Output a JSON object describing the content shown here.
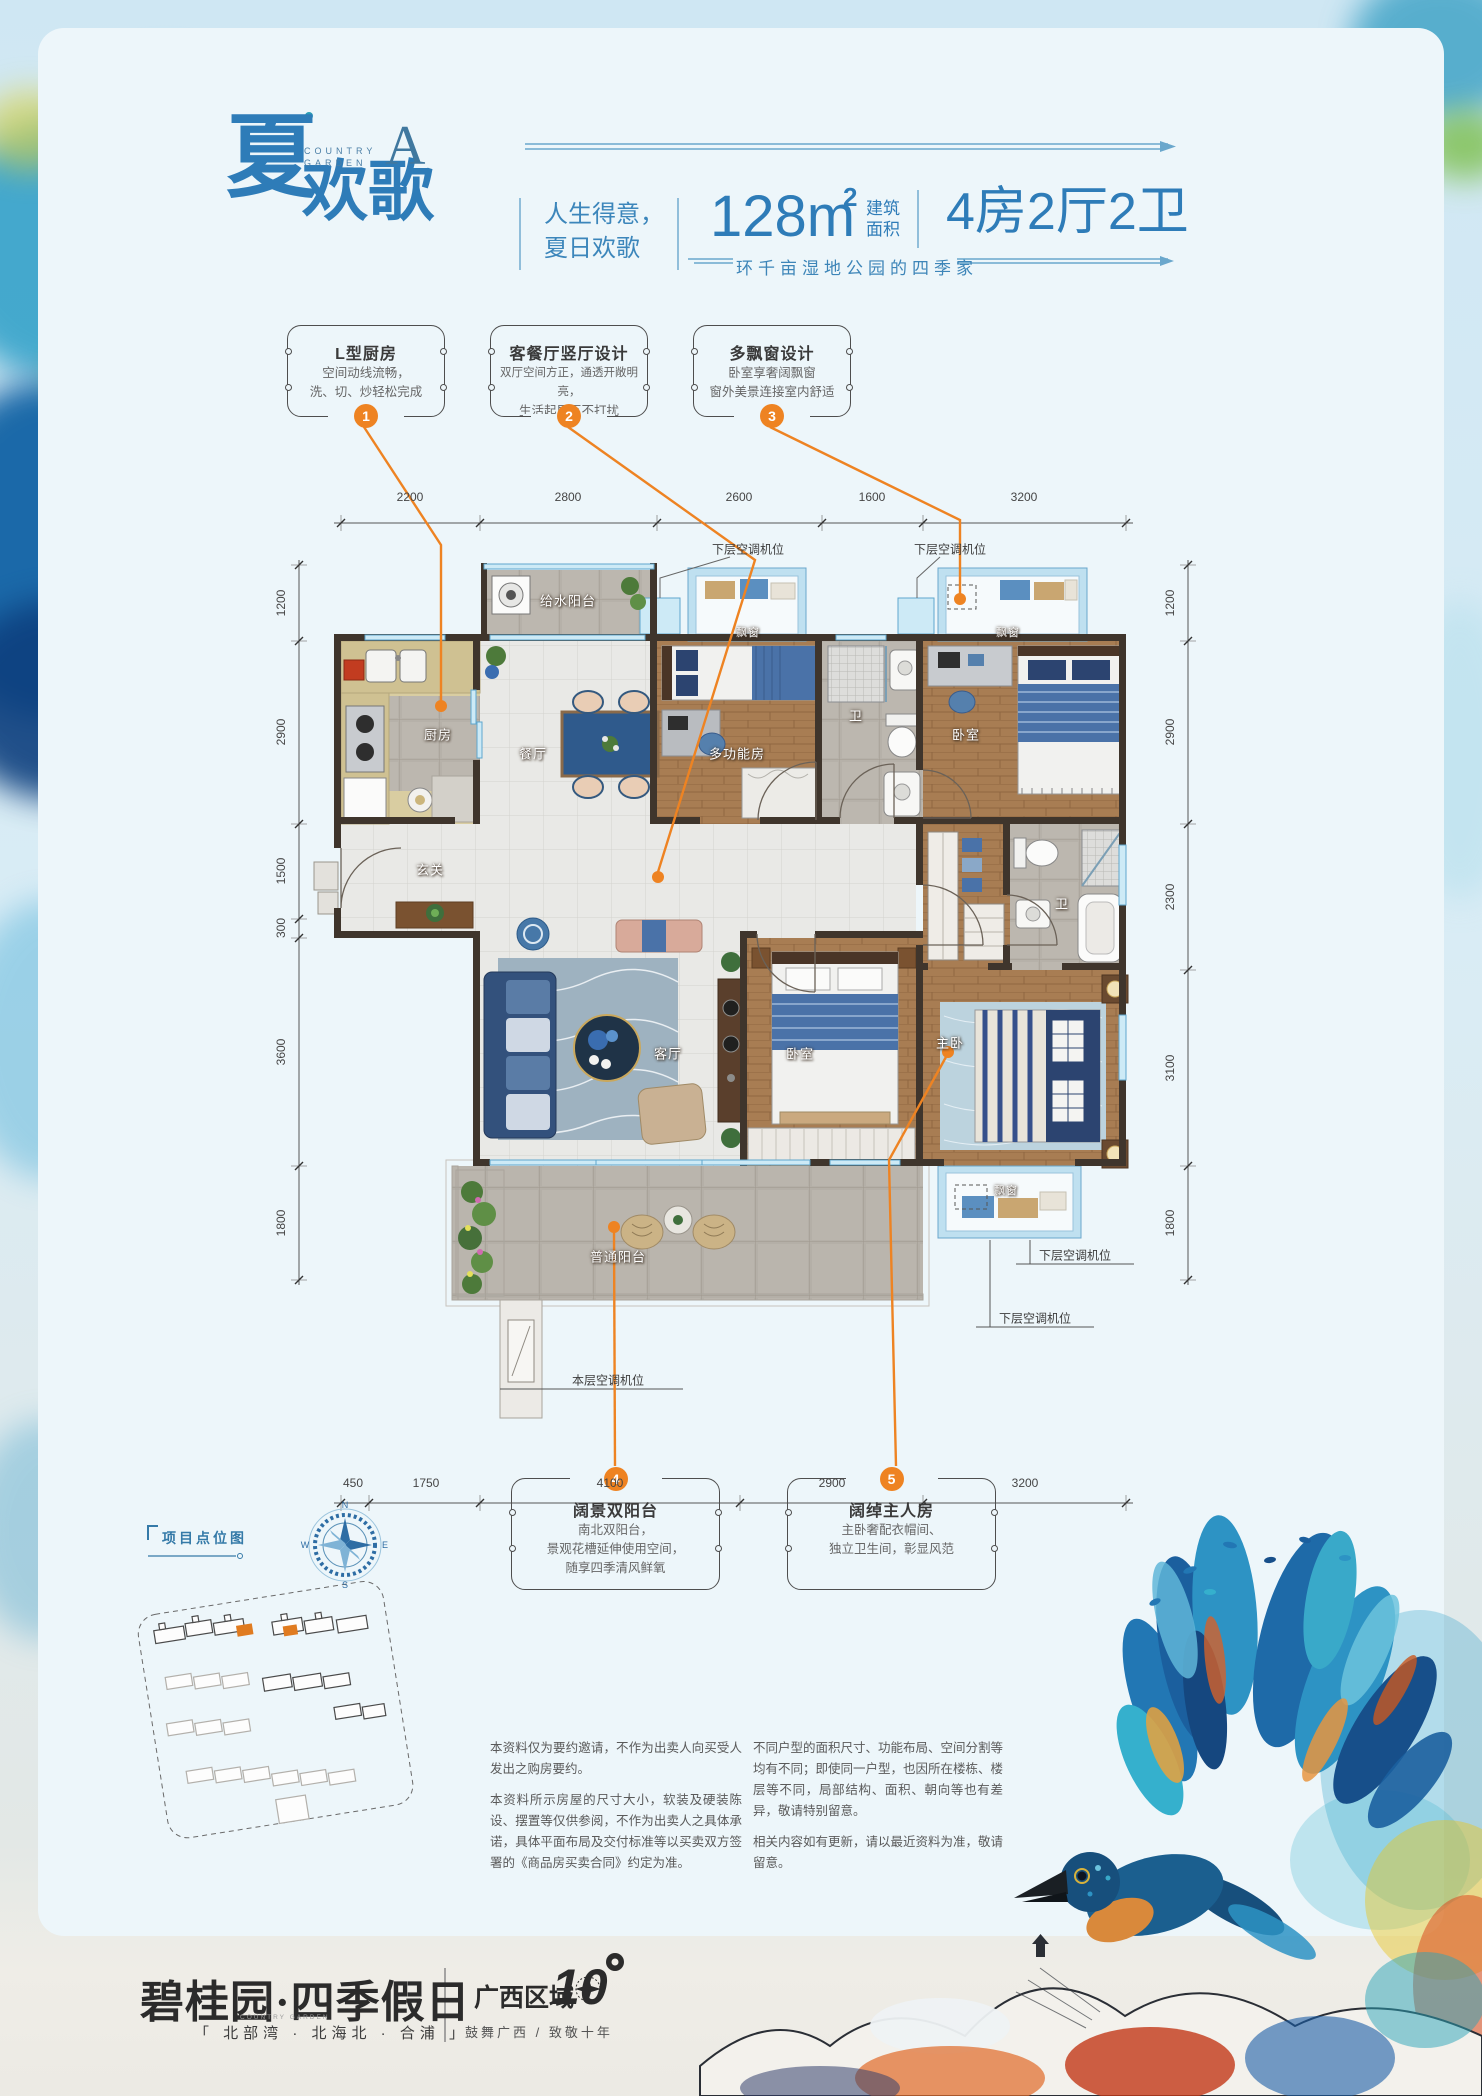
{
  "header": {
    "logo_char_main": "夏",
    "logo_chars_sub": "欢歌",
    "brand_line1": "COUNTRY",
    "brand_line2": "GARDEN",
    "unit_letter": "A",
    "slogan_line1": "人生得意，",
    "slogan_line2": "夏日欢歌",
    "area_number": "128m",
    "area_sup": "2",
    "area_unit_line1": "建筑",
    "area_unit_line2": "面积",
    "layout_text": "4房2厅2卫",
    "tagline": "环千亩湿地公园的四季家"
  },
  "features": {
    "f1": {
      "num": "1",
      "title": "L型厨房",
      "line1": "空间动线流畅，",
      "line2": "洗、切、炒轻松完成"
    },
    "f2": {
      "num": "2",
      "title": "客餐厅竖厅设计",
      "line1": "双厅空间方正，通透开敞明亮，",
      "line2": "生活起居互不打扰"
    },
    "f3": {
      "num": "3",
      "title": "多飘窗设计",
      "line1": "卧室享奢阔飘窗",
      "line2": "窗外美景连接室内舒适"
    },
    "f4": {
      "num": "4",
      "title": "阔景双阳台",
      "line1": "南北双阳台，",
      "line2": "景观花槽延伸使用空间，",
      "line3": "随享四季清风鲜氧"
    },
    "f5": {
      "num": "5",
      "title": "阔绰主人房",
      "line1": "主卧奢配衣帽间、",
      "line2": "独立卫生间，彰显风范"
    }
  },
  "plan": {
    "rooms": {
      "water_balcony": "给水阳台",
      "kitchen": "厨房",
      "dining": "餐厅",
      "bay_window": "飘窗",
      "multi_room": "多功能房",
      "bath": "卫",
      "bedroom": "卧室",
      "entry": "玄关",
      "living": "客厅",
      "master": "主卧",
      "balcony": "普通阳台"
    },
    "ac": {
      "lower": "下层空调机位",
      "current": "本层空调机位"
    },
    "dims": {
      "top": [
        "2200",
        "2800",
        "2600",
        "1600",
        "3200"
      ],
      "left": [
        "1200",
        "2900",
        "1500",
        "300",
        "3600",
        "1800"
      ],
      "right": [
        "1200",
        "2900",
        "2300",
        "3100",
        "1800"
      ],
      "bottom": [
        "450",
        "1750",
        "4100",
        "2900",
        "3200"
      ]
    }
  },
  "sitemap": {
    "title": "项目点位图",
    "compass_n": "N",
    "compass_e": "E",
    "compass_s": "S",
    "compass_w": "W"
  },
  "disclaimer": {
    "left1": "本资料仅为要约邀请，不作为出卖人向买受人发出之购房要约。",
    "left2": "本资料所示房屋的尺寸大小，软装及硬装陈设、摆置等仅供参阅，不作为出卖人之具体承诺，具体平面布局及交付标准等以买卖双方签署的《商品房买卖合同》约定为准。",
    "right1": "不同户型的面积尺寸、功能布局、空间分割等均有不同；即使同一户型，也因所在楼栋、楼层等不同，局部结构、面积、朝向等也有差异，敬请特别留意。",
    "right2": "相关内容如有更新，请以最近资料为准，敬请留意。"
  },
  "footer": {
    "logo": "碧桂园·四季假日",
    "brand_small": "COUNTRY GARDEN",
    "sub": "「 北部湾 · 北海北 · 合浦 」",
    "region": "广西区域",
    "ten": "10",
    "slogan": "鼓舞广西 / 致敬十年"
  },
  "colors": {
    "accent_orange": "#ee8322",
    "brand_blue": "#2e7cb8"
  }
}
